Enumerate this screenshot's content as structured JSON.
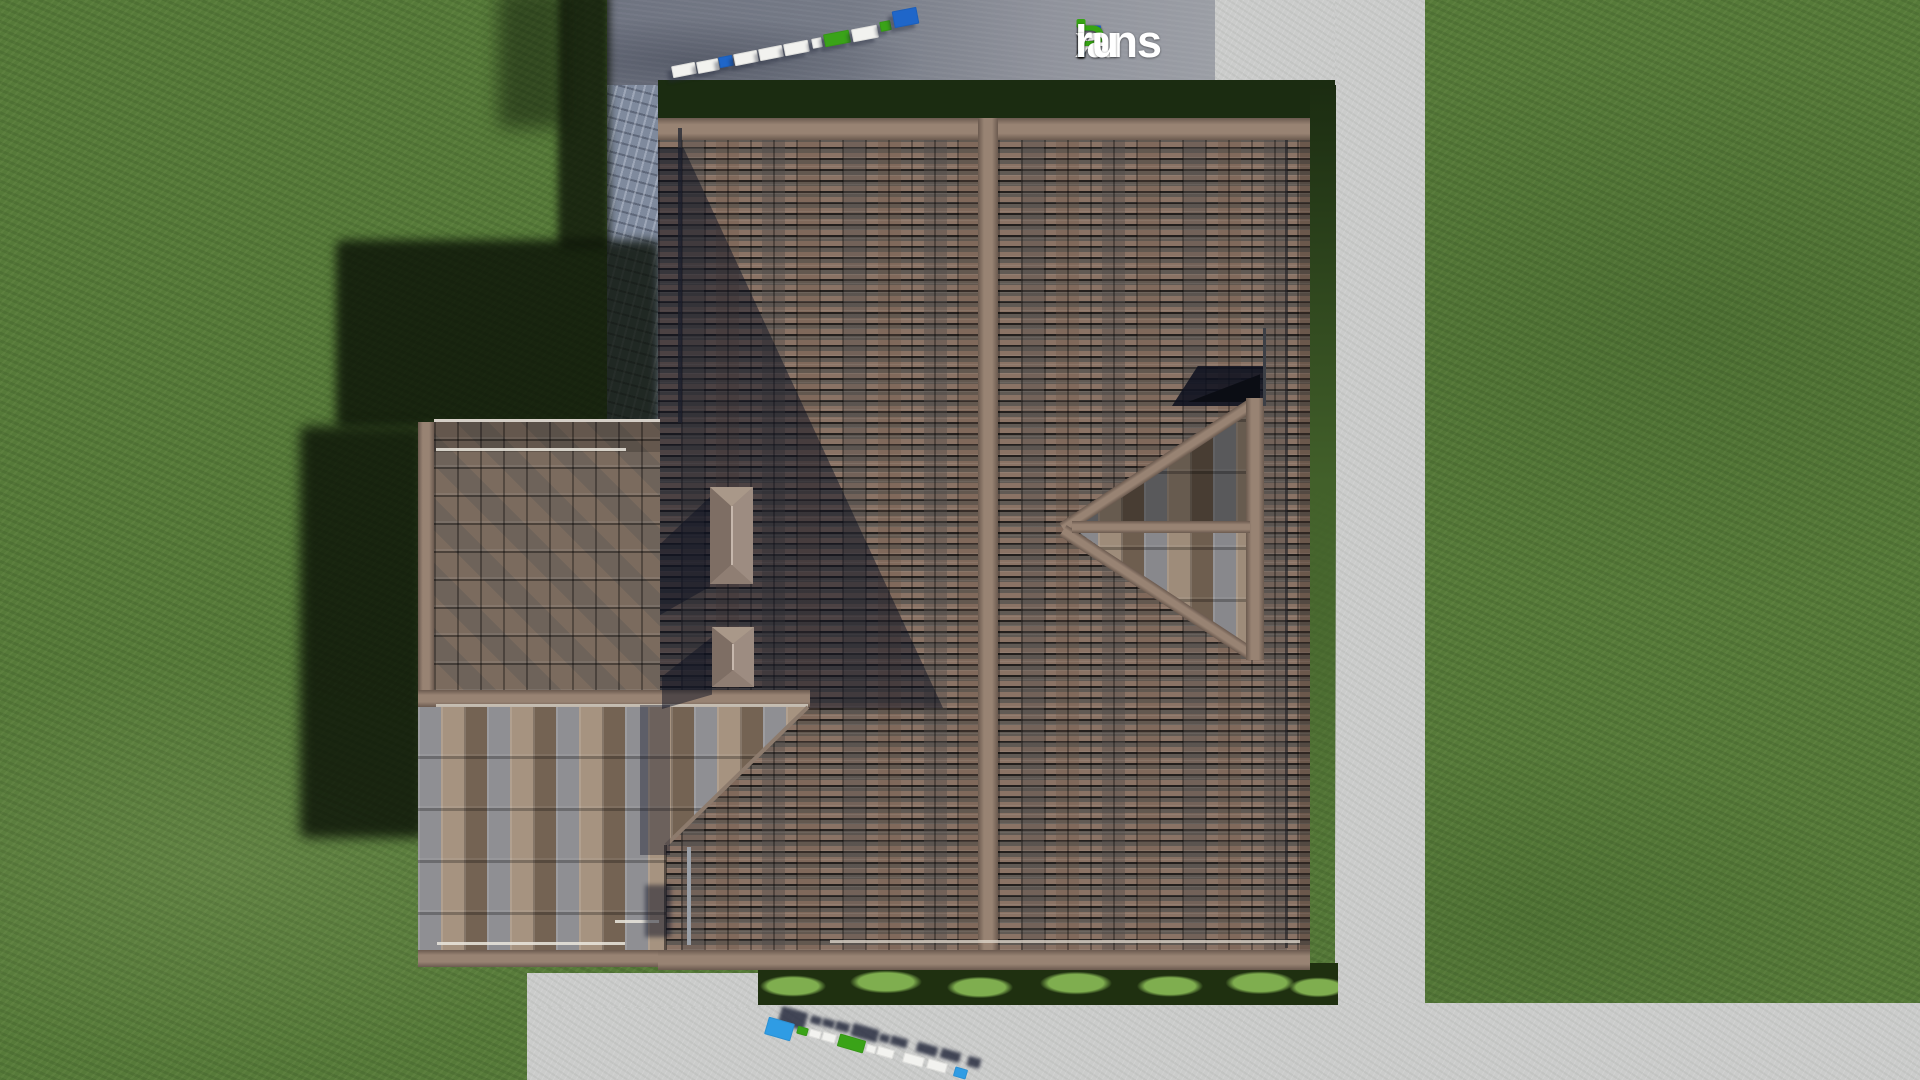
{
  "watermark": {
    "site_label": "FixPlans.ru",
    "parts": [
      {
        "text": "F",
        "color": "#1e62c8"
      },
      {
        "text": "i",
        "color": "#ffffff",
        "dot": "#36a414"
      },
      {
        "text": "x",
        "color": "#ffffff"
      },
      {
        "text": "P",
        "color": "#36a414"
      },
      {
        "text": "lans",
        "color": "#ffffff"
      },
      {
        "text": ".",
        "color": "#2a93dd"
      },
      {
        "text": "ru",
        "color": "#ffffff"
      }
    ]
  },
  "scene": {
    "view": "top-down aerial render",
    "subject": "house-roof-plan",
    "elements": [
      "lawn",
      "asphalt-road",
      "stone-driveway",
      "concrete-path",
      "concrete-pavement",
      "main-roof",
      "left-wing-roof",
      "gable-dormer",
      "chimney",
      "chimney",
      "shrub-bed",
      "antenna"
    ]
  },
  "palette": {
    "grass": "#567a39",
    "grass_dark": "#1b2c11",
    "road_l": "#6e7380",
    "road_r": "#9b9ea5",
    "stone": "#7f8a9d",
    "path": "#cbcccb",
    "tile_gap": "#231f1d",
    "tile_brown": "#8a7365",
    "tile_gray": "#615a54",
    "ridge": "#988373",
    "ridge_dark": "#6b5a4f",
    "wing_base": "#6e635a",
    "wing_gray": "#8f8f93",
    "wing_tan": "#a69380",
    "wing_brown": "#746353",
    "bush_dark": "#1f3010",
    "bush_light": "#7fae4f",
    "chimney": "#93817a",
    "shadow": "rgba(13,17,33,0.5)",
    "block_white": "#f2f2ef",
    "block_blue": "#1f66c9",
    "block_blue2": "#2f9ce4",
    "block_green": "#3aa318"
  },
  "block_chains": {
    "top": {
      "rotation": -11,
      "blocks": [
        {
          "x": 672,
          "y": 64,
          "w": 24,
          "h": 12,
          "c": "block_white"
        },
        {
          "x": 697,
          "y": 60,
          "w": 22,
          "h": 12,
          "c": "block_white"
        },
        {
          "x": 719,
          "y": 56,
          "w": 14,
          "h": 11,
          "c": "block_blue"
        },
        {
          "x": 734,
          "y": 52,
          "w": 24,
          "h": 12,
          "c": "block_white"
        },
        {
          "x": 759,
          "y": 47,
          "w": 24,
          "h": 12,
          "c": "block_white"
        },
        {
          "x": 784,
          "y": 42,
          "w": 25,
          "h": 12,
          "c": "block_white"
        },
        {
          "x": 812,
          "y": 38,
          "w": 10,
          "h": 10,
          "c": "block_white"
        },
        {
          "x": 824,
          "y": 32,
          "w": 26,
          "h": 13,
          "c": "block_green"
        },
        {
          "x": 852,
          "y": 27,
          "w": 26,
          "h": 13,
          "c": "block_white"
        },
        {
          "x": 880,
          "y": 21,
          "w": 11,
          "h": 10,
          "c": "block_green"
        },
        {
          "x": 893,
          "y": 9,
          "w": 25,
          "h": 17,
          "c": "block_blue"
        }
      ]
    },
    "bottom": {
      "rotation": 16,
      "blocks": [
        {
          "x": 766,
          "y": 1020,
          "w": 27,
          "h": 18,
          "c": "block_blue2"
        },
        {
          "x": 797,
          "y": 1027,
          "w": 11,
          "h": 8,
          "c": "block_green"
        },
        {
          "x": 809,
          "y": 1030,
          "w": 12,
          "h": 8,
          "c": "block_white"
        },
        {
          "x": 822,
          "y": 1033,
          "w": 14,
          "h": 9,
          "c": "block_white"
        },
        {
          "x": 838,
          "y": 1037,
          "w": 27,
          "h": 13,
          "c": "block_green"
        },
        {
          "x": 866,
          "y": 1045,
          "w": 10,
          "h": 8,
          "c": "block_white"
        },
        {
          "x": 877,
          "y": 1048,
          "w": 17,
          "h": 9,
          "c": "block_white"
        },
        {
          "x": 903,
          "y": 1055,
          "w": 21,
          "h": 10,
          "c": "block_white"
        },
        {
          "x": 927,
          "y": 1061,
          "w": 20,
          "h": 10,
          "c": "block_white"
        },
        {
          "x": 954,
          "y": 1068,
          "w": 13,
          "h": 10,
          "c": "block_blue2"
        }
      ]
    }
  }
}
